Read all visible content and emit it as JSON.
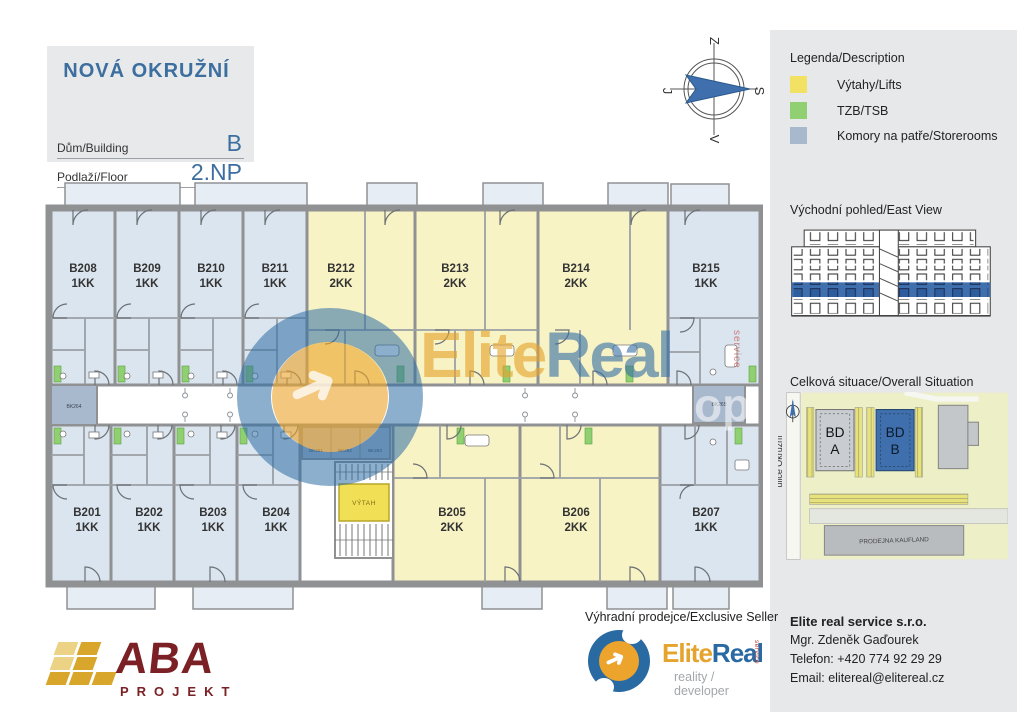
{
  "title_block": {
    "title": "NOVÁ OKRUŽNÍ",
    "building_label": "Dům/Building",
    "building_value": "B",
    "floor_label": "Podlaží/Floor",
    "floor_value": "2.NP"
  },
  "compass": {
    "top": "Z",
    "right": "S",
    "bottom": "V",
    "left": "J"
  },
  "legend": {
    "title": "Legenda/Description",
    "items": [
      {
        "label": "Výtahy/Lifts",
        "color": "#f3e163"
      },
      {
        "label": "TZB/TSB",
        "color": "#90d072"
      },
      {
        "label": "Komory na patře/Storerooms",
        "color": "#a9b9cd"
      }
    ]
  },
  "east_view": {
    "title": "Východní pohled/East View"
  },
  "situation": {
    "title": "Celková situace/Overall Situation",
    "street": "ulice Okružní",
    "bd_a_line1": "BD",
    "bd_a_line2": "A",
    "bd_b_line1": "BD",
    "bd_b_line2": "B",
    "kaufland": "PRODEJNA KAUFLAND"
  },
  "plan": {
    "units": [
      {
        "id": "B208",
        "type": "1KK"
      },
      {
        "id": "B209",
        "type": "1KK"
      },
      {
        "id": "B210",
        "type": "1KK"
      },
      {
        "id": "B211",
        "type": "1KK"
      },
      {
        "id": "B212",
        "type": "2KK"
      },
      {
        "id": "B213",
        "type": "2KK"
      },
      {
        "id": "B214",
        "type": "2KK"
      },
      {
        "id": "B215",
        "type": "1KK"
      },
      {
        "id": "B201",
        "type": "1KK"
      },
      {
        "id": "B202",
        "type": "1KK"
      },
      {
        "id": "B203",
        "type": "1KK"
      },
      {
        "id": "B204",
        "type": "1KK"
      },
      {
        "id": "B205",
        "type": "2KK"
      },
      {
        "id": "B206",
        "type": "2KK"
      },
      {
        "id": "B207",
        "type": "1KK"
      }
    ],
    "lift": "VÝTAH",
    "storerooms": {
      "bk261": "BK261",
      "bk262": "BK262",
      "bk263": "BK263",
      "bk264": "BK264",
      "bk265": "BK265"
    }
  },
  "watermark": {
    "elite": "Elite",
    "real": "Real",
    "service": "service",
    "op": "op",
    "arrow": "➜"
  },
  "seller": {
    "caption": "Výhradní prodejce/Exclusive Seller",
    "brand_elite": "Elite",
    "brand_real": "Real",
    "brand_service": "service",
    "brand_sub": "reality / developer",
    "arrow": "➜"
  },
  "contact": {
    "company": "Elite real service s.r.o.",
    "person": "Mgr. Zdeněk Gaďourek",
    "phone": "Telefon: +420 774 92 29 29",
    "email": "Email: elitereal@elitereal.cz"
  },
  "aba": {
    "name": "ABA",
    "sub": "PROJEKT"
  },
  "colors": {
    "accent_blue": "#3c6e9f",
    "unit_1kk_fill": "#dbe5ef",
    "unit_2kk_fill": "#f8f3c5",
    "lift_fill": "#f1df55",
    "tzb_green": "#90d072",
    "storeroom_fill": "#a9b9cd",
    "floor_highlight": "#3f6fad",
    "wall_gray": "#8f9193",
    "logo_orange": "#eca42d",
    "logo_blue": "#2a6aa3",
    "aba_red": "#7b2125",
    "aba_gold": "#d9a62c"
  }
}
